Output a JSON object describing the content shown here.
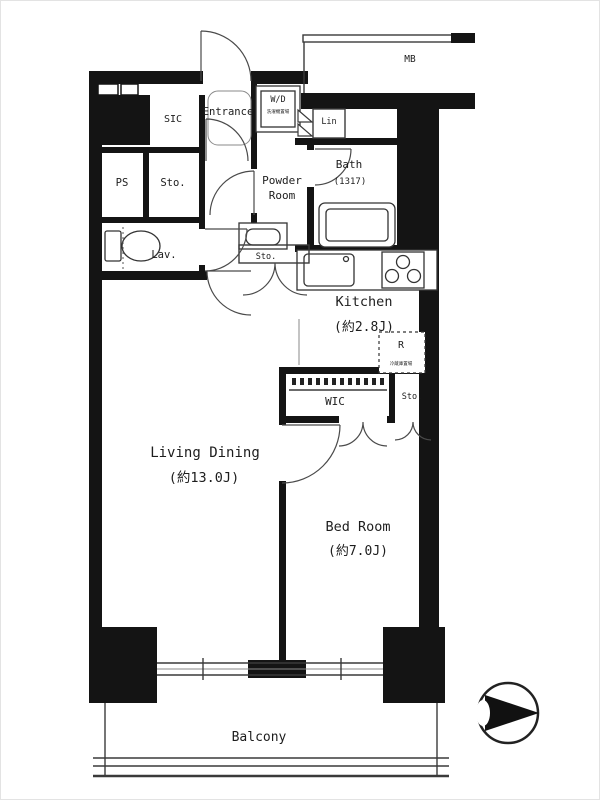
{
  "plan": {
    "rooms": {
      "living_dining": {
        "name": "Living Dining",
        "size": "(約13.0J)"
      },
      "bed_room": {
        "name": "Bed Room",
        "size": "(約7.0J)"
      },
      "kitchen": {
        "name": "Kitchen",
        "size": "(約2.8J)"
      },
      "bath": {
        "name": "Bath",
        "size": "(1317)"
      },
      "powder_room": {
        "name_line1": "Powder",
        "name_line2": "Room"
      },
      "lavatory": "Lav.",
      "entrance": "Entrance",
      "shoe_closet": "SIC",
      "walk_in_closet": "WIC",
      "balcony": "Balcony"
    },
    "storage": {
      "hall_storage": "Sto.",
      "powder_storage": "Sto.",
      "bedroom_storage": "Sto.",
      "linen": "Lin",
      "pipe_shaft": "PS",
      "meter_box": "MB"
    },
    "appliances": {
      "washer_dryer": "W/D",
      "washer_dryer_note": "洗濯機置場",
      "refrigerator": "R",
      "refrigerator_note": "冷蔵庫置場"
    },
    "compass": {
      "icon": "north-arrow-icon",
      "points": "right"
    },
    "colors": {
      "walls": "#141414",
      "lines": "#3a3a3a",
      "background": "#ffffff"
    }
  }
}
